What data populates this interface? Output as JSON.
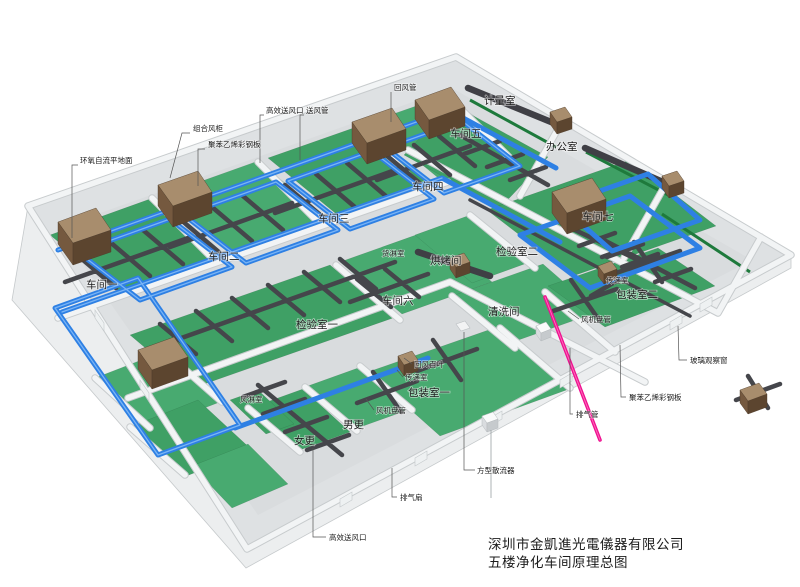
{
  "title": {
    "company": "深圳市金凱進光電儀器有限公司",
    "drawing": "五楼净化车间原理总图"
  },
  "rooms": {
    "workshop1": "车间一",
    "workshop2": "车间二",
    "workshop3": "车间三",
    "workshop4": "车间四",
    "workshop5": "车间五",
    "workshop6": "车间六",
    "workshop7": "车间七",
    "metrology": "计量室",
    "office": "办公室",
    "inspection1": "检验室一",
    "inspection2": "检验室二",
    "packing1": "包装室一",
    "packing2": "包装室二",
    "baking": "烘烤间",
    "cleaning": "清洗间",
    "cargo_shower": "货淋室",
    "air_shower": "风淋室",
    "pass_box1": "传递室",
    "pass_box2": "传递室",
    "female_change": "女更",
    "male_change": "男更"
  },
  "annotations": {
    "epoxy_floor": "环氧自流平地面",
    "air_handling_unit": "组合风柜",
    "steel_panel_top": "聚苯乙烯彩钢板",
    "hepa_outlet_top": "高效送风口",
    "supply_duct": "送风管",
    "return_duct": "回风管",
    "return_louver": "回风百叶",
    "fcu_1": "风机盘管",
    "fcu_2": "风机盘管",
    "square_diffuser": "方型散流器",
    "exhaust_fan": "排气扇",
    "hepa_outlet_bottom": "高效送风口",
    "exhaust_pipe": "排气管",
    "steel_panel_right": "聚苯乙烯彩钢板",
    "glass_window": "玻璃观察窗"
  },
  "colors": {
    "blue_duct": "#2e80e4",
    "blue_duct_hl": "#7ab4f5",
    "duct_gray": "#45464b",
    "floor_green": "#3fa065",
    "floor_green_2": "#48aa70",
    "green_strip": "#1e7a3c",
    "magenta": "#ee1090",
    "wall": "#f2f4f5",
    "wall_edge": "#c7cbcd",
    "slab": "#eceeef",
    "slab_top": "#dee1e3",
    "slab_inner": "#d9dcde",
    "ahu_top": "#a88d6d",
    "ahu_front": "#75593f",
    "ahu_side": "#5c452f",
    "label": "#1c1c1c",
    "leader": "#555555"
  }
}
